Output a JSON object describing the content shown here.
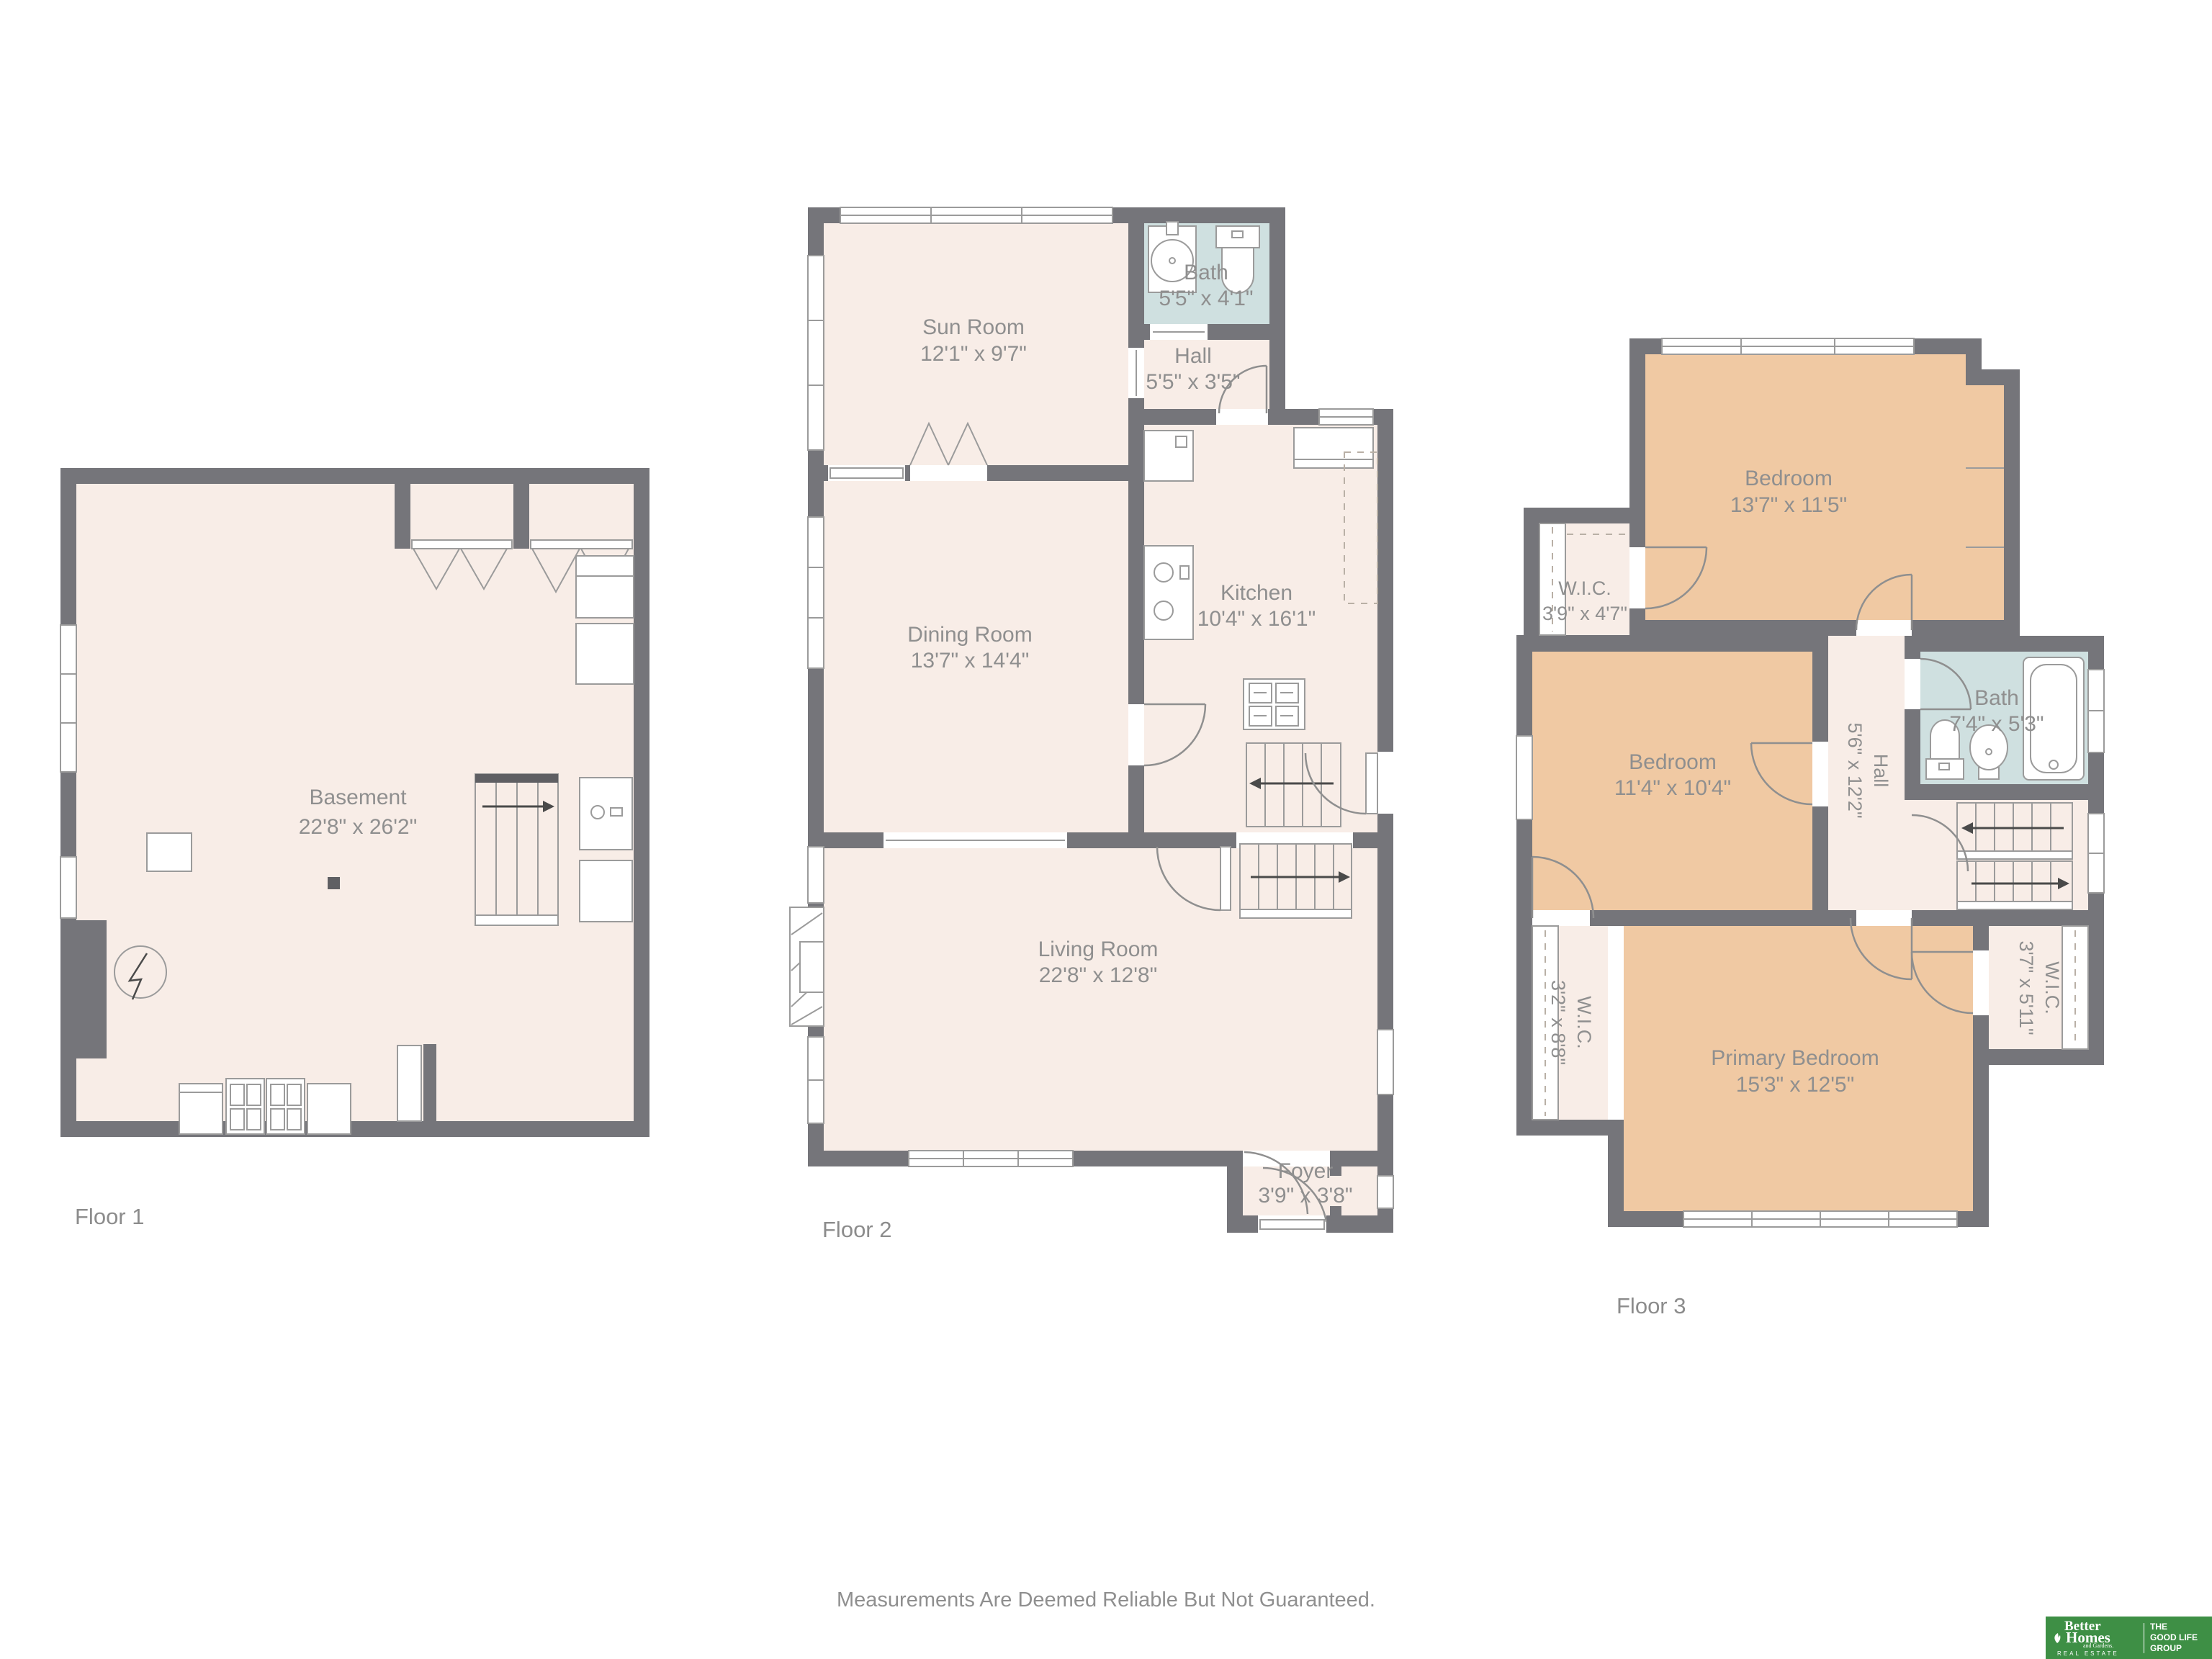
{
  "page": {
    "disclaimer": "Measurements Are Deemed Reliable But Not Guaranteed."
  },
  "colors": {
    "wall": "#75757a",
    "floor": "#f8ede7",
    "bedroom": "#f0c9a3",
    "bath": "#cfe0e0",
    "label_text": "#8f8f8f",
    "logo_green": "#3e8f45"
  },
  "floors": [
    {
      "label": "Floor 1",
      "rooms": [
        {
          "name": "Basement",
          "dims": "22'8\" x 26'2\""
        }
      ]
    },
    {
      "label": "Floor 2",
      "rooms": [
        {
          "name": "Sun Room",
          "dims": "12'1\" x 9'7\""
        },
        {
          "name": "Bath",
          "dims": "5'5\" x 4'1\""
        },
        {
          "name": "Hall",
          "dims": "5'5\" x 3'5\""
        },
        {
          "name": "Kitchen",
          "dims": "10'4\" x 16'1\""
        },
        {
          "name": "Dining Room",
          "dims": "13'7\" x 14'4\""
        },
        {
          "name": "Living Room",
          "dims": "22'8\" x 12'8\""
        },
        {
          "name": "Foyer",
          "dims": "3'9\" x 3'8\""
        }
      ]
    },
    {
      "label": "Floor 3",
      "rooms": [
        {
          "name": "Bedroom",
          "dims": "13'7\" x 11'5\""
        },
        {
          "name": "W.I.C.",
          "dims": "3'9\" x 4'7\""
        },
        {
          "name": "Bath",
          "dims": "7'4\" x 5'3\""
        },
        {
          "name": "Bedroom",
          "dims": "11'4\" x 10'4\""
        },
        {
          "name": "Hall",
          "dims": "5'6\" x 12'2\""
        },
        {
          "name": "W.I.C.",
          "dims": "3'2\" x 8'8\""
        },
        {
          "name": "Primary Bedroom",
          "dims": "15'3\" x 12'5\""
        },
        {
          "name": "W.I.C.",
          "dims": "3'7\" x 5'11\""
        }
      ]
    }
  ],
  "logo": {
    "brand_line1": "Better",
    "brand_line2": "Homes",
    "brand_sub": "and Gardens.",
    "brand_tagline": "REAL ESTATE",
    "right_line1": "THE",
    "right_line2": "GOOD LIFE",
    "right_line3": "GROUP"
  }
}
